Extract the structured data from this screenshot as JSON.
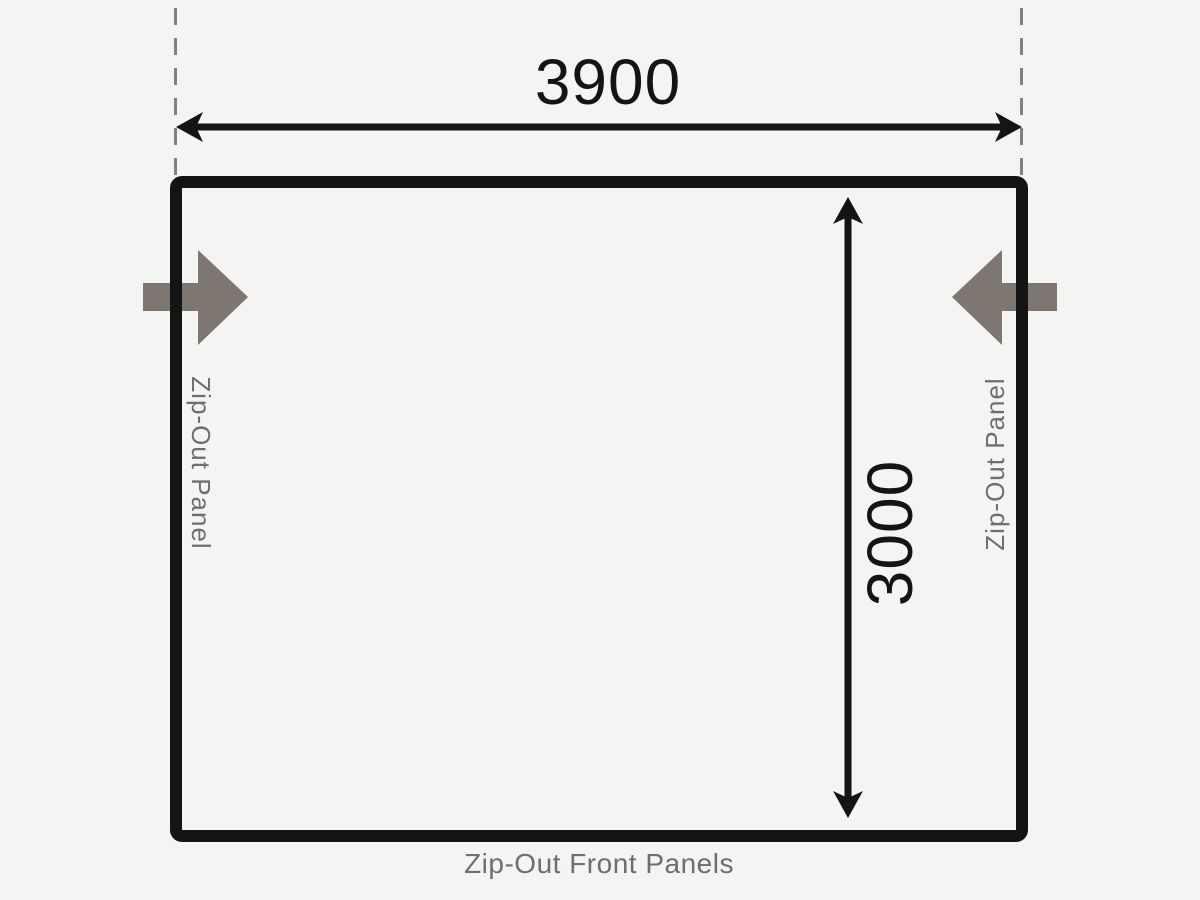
{
  "diagram": {
    "title": "Awning floor plan",
    "width_dimension": "3900",
    "height_dimension": "3000",
    "left_panel_label": "Zip-Out Panel",
    "right_panel_label": "Zip-Out Panel",
    "bottom_label": "Zip-Out Front Panels",
    "colors": {
      "background": "#f4f4f2",
      "line": "#141414",
      "accent_arrow": "#7e7671",
      "label_gray": "#6e6e6d",
      "dash_gray": "#818181"
    }
  }
}
